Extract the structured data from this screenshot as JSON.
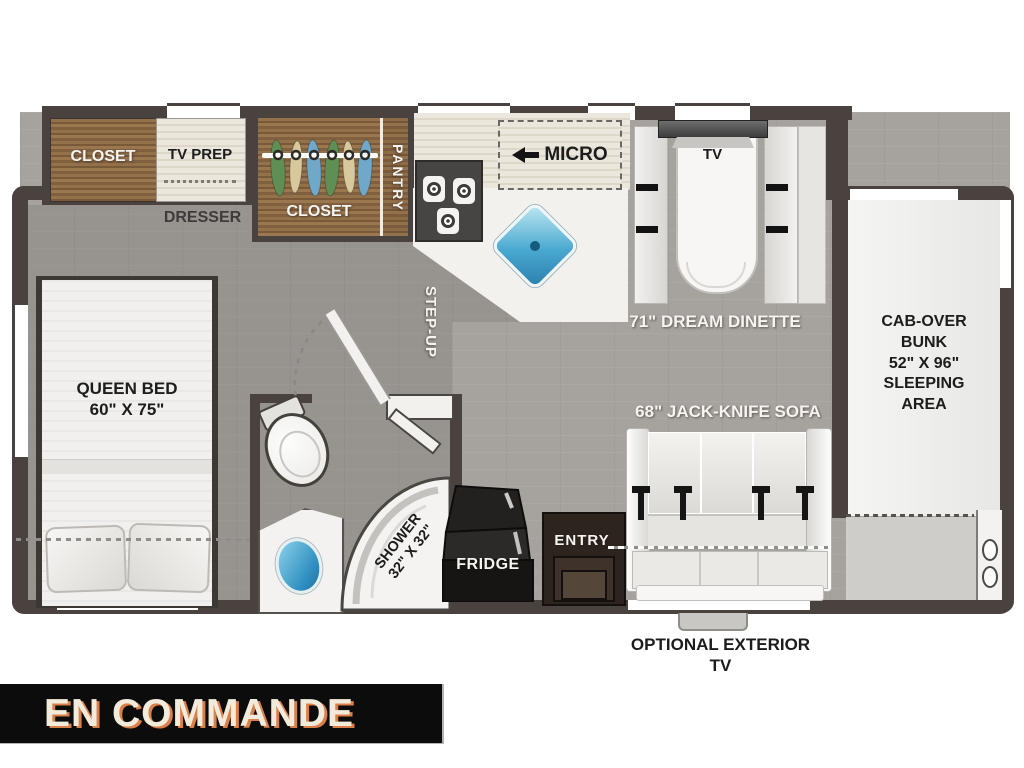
{
  "banner": {
    "text": "EN COMMANDE",
    "bg": "#0c0c0c",
    "text_color": "#f2ebdc",
    "shadow_color": "#d9804a"
  },
  "rooms": {
    "closet_left": "CLOSET",
    "tv_prep": "TV PREP",
    "dresser": "DRESSER",
    "closet_mid": "CLOSET",
    "pantry": "PANTRY",
    "micro": "MICRO",
    "tv": "TV",
    "dinette": "71\" DREAM DINETTE",
    "cab_over": "CAB-OVER\nBUNK\n52\" X 96\"\nSLEEPING\nAREA",
    "queen_bed": "QUEEN BED\n60\" X 75\"",
    "step_up": "STEP-UP",
    "shower": "SHOWER\n32\" X 32\"",
    "fridge": "FRIDGE",
    "entry": "ENTRY",
    "sofa": "68\" JACK-KNIFE SOFA",
    "exterior_tv": "OPTIONAL EXTERIOR TV"
  },
  "colors": {
    "wall": "#4a423e",
    "floor": "#a6a29e",
    "floor_raised_overlay": "rgba(55,50,48,0.13)",
    "wood": "#8a6743",
    "counter": "#e9e4da",
    "furniture_white": "#f2f1ee",
    "sink_blue": "#3fa0cd",
    "fridge_black": "#161514",
    "entry_brown": "#2e241e"
  },
  "icons": {
    "micro_arrow": "left-arrow",
    "hangers": [
      "green",
      "tan",
      "blue",
      "green",
      "tan",
      "blue"
    ],
    "stove_burners": 3,
    "cup_holders": 2
  }
}
